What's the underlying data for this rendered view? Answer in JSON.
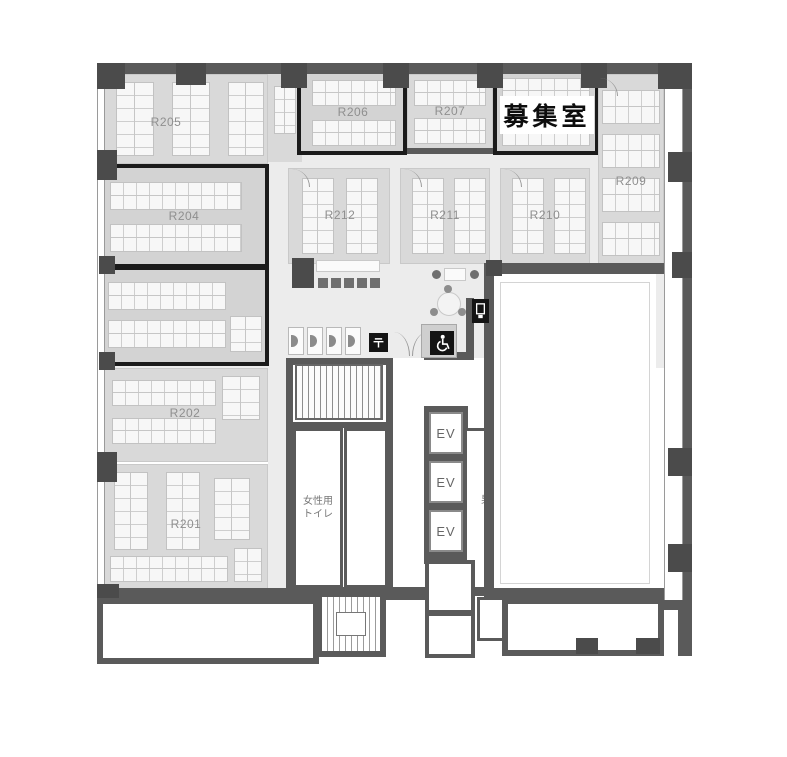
{
  "rooms": {
    "r201": {
      "label": "R201",
      "highlighted": false
    },
    "r202": {
      "label": "R202",
      "highlighted": false
    },
    "r203": {
      "label": "",
      "highlighted": true
    },
    "r204": {
      "label": "R204",
      "highlighted": true
    },
    "r205": {
      "label": "R205",
      "highlighted": false
    },
    "r206": {
      "label": "R206",
      "highlighted": true
    },
    "r207": {
      "label": "R207",
      "highlighted": false
    },
    "r209": {
      "label": "R209",
      "highlighted": false
    },
    "r210": {
      "label": "R210",
      "highlighted": false
    },
    "r211": {
      "label": "R211",
      "highlighted": false
    },
    "r212": {
      "label": "R212",
      "highlighted": false
    },
    "recruit": {
      "label": "募集室",
      "highlighted": true
    }
  },
  "core": {
    "ev1": "EV",
    "ev2": "EV",
    "ev3": "EV",
    "womens_toilet_line1": "女性用",
    "womens_toilet_line2": "トイレ",
    "mens_toilet_line1": "男性用",
    "mens_toilet_line2": "トイレ"
  },
  "icons": {
    "postal_mark": "〒",
    "wheelchair": "wheelchair-accessible-toilet",
    "vending": "vending-machine"
  },
  "colors": {
    "wall": "#5a5a5a",
    "room_fill": "#d9d9d9",
    "corridor_fill": "#ececec",
    "highlight_border": "#1b1b1b",
    "label_gray": "#8f8f8f",
    "recruit_text": "#0d0d0d"
  }
}
